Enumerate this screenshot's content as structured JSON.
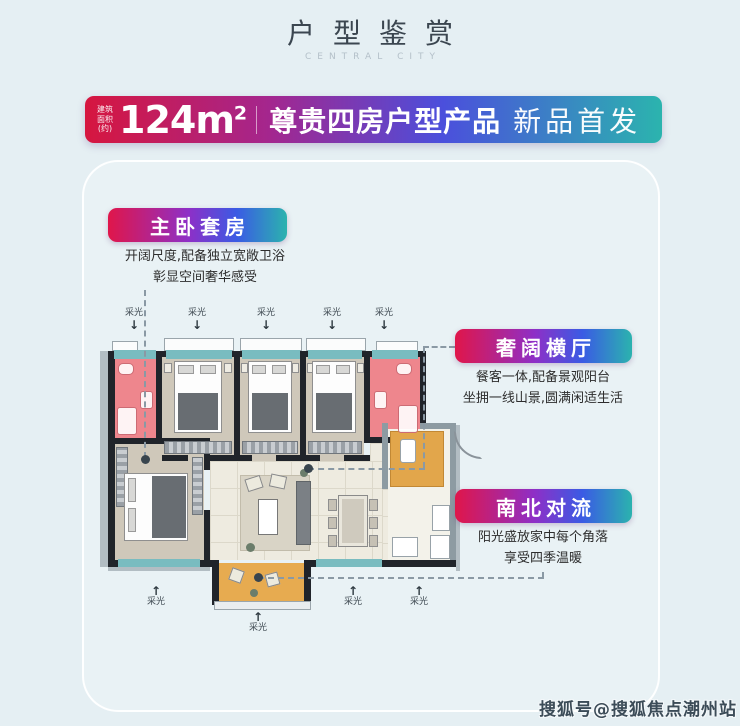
{
  "header": {
    "title": "户型鉴赏",
    "subtitle": "CENTRAL CITY"
  },
  "banner": {
    "area_prefix_lines": [
      "建筑",
      "面积",
      "(约)"
    ],
    "area_value": "124m",
    "area_sup": "2",
    "headline": "尊贵四房户型产品",
    "highlight": "新品首发",
    "gradient_start": "#d6163f",
    "gradient_mid": "#4b4fdc",
    "gradient_end": "#2bb4ae"
  },
  "callouts": [
    {
      "title": "主卧套房",
      "lines": [
        "开阔尺度,配备独立宽敞卫浴",
        "彰显空间奢华感受"
      ]
    },
    {
      "title": "奢阔横厅",
      "lines": [
        "餐客一体,配备景观阳台",
        "坐拥一线山景,圆满闲适生活"
      ]
    },
    {
      "title": "南北对流",
      "lines": [
        "阳光盛放家中每个角落",
        "享受四季温暖"
      ]
    }
  ],
  "floorplan": {
    "daylight_label": "采光",
    "top_arrow_count": 5,
    "bottom_arrow_count": 4,
    "colors": {
      "wall": "#20242a",
      "bedroom_floor": "#cfc8ba",
      "living_floor": "#eeebe0",
      "bathroom": "#ee868d",
      "window": "#79bcc0",
      "balcony_kitchen": "#e7ab50",
      "outer_band": "#b2bdc3"
    }
  },
  "icons": {
    "arrow_down": "↓",
    "arrow_up": "↑"
  },
  "watermark": "搜狐号@搜狐焦点潮州站"
}
